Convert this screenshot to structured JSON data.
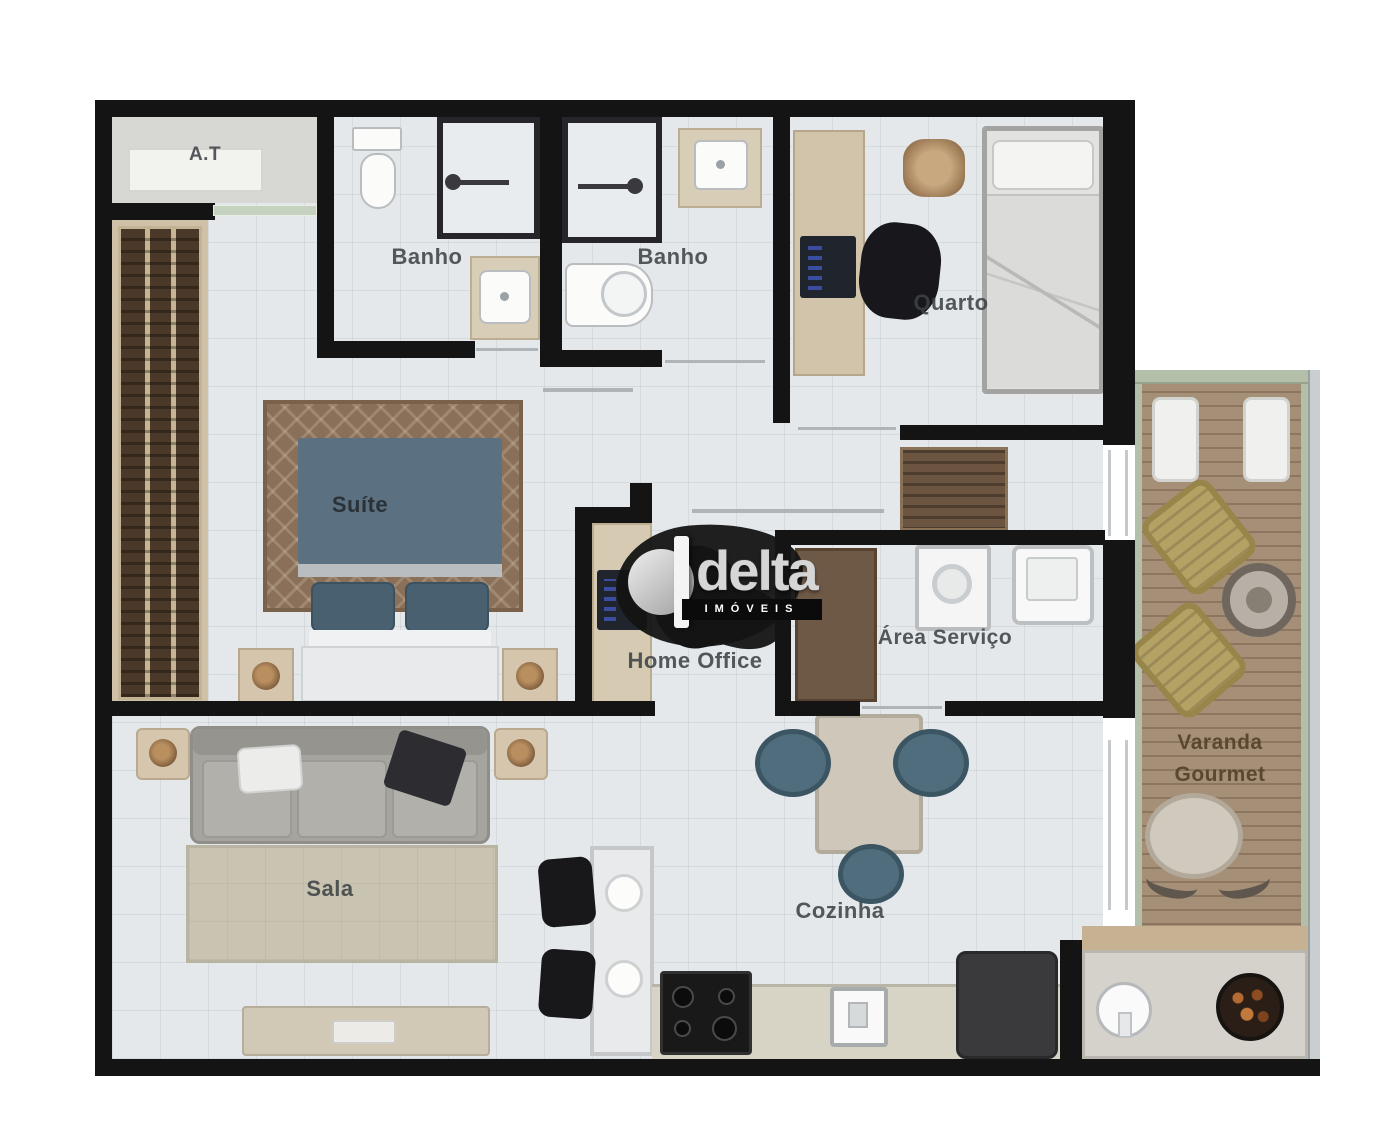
{
  "title": "Apartment floor plan",
  "watermark": {
    "brand": "delta",
    "subtitle": "IMÓVEIS"
  },
  "rooms": {
    "at": {
      "label": "A.T"
    },
    "banho1": {
      "label": "Banho"
    },
    "banho2": {
      "label": "Banho"
    },
    "quarto": {
      "label": "Quarto"
    },
    "suite": {
      "label": "Suíte"
    },
    "home_office": {
      "label": "Home Office"
    },
    "area_servico": {
      "label": "Área Serviço"
    },
    "sala": {
      "label": "Sala"
    },
    "cozinha": {
      "label": "Cozinha"
    },
    "varanda": {
      "label_line1": "Varanda",
      "label_line2": "Gourmet"
    }
  },
  "colors": {
    "wall": "#141414",
    "floor_tile": "#e4e8eb",
    "wood_deck": "#a58f77",
    "varanda_border": "#b4bfa9",
    "rug_sala": "#c9c3b1",
    "rug_suite": "#8a7058",
    "headboard": "#5b7080",
    "kitchen_chair": "#4f6d7d",
    "wardrobe": "#4a3828",
    "counter": "#d7d3c5",
    "lounge_chair": "#b4a265",
    "label_text": "#3e4246",
    "watermark_black": "#141414"
  }
}
